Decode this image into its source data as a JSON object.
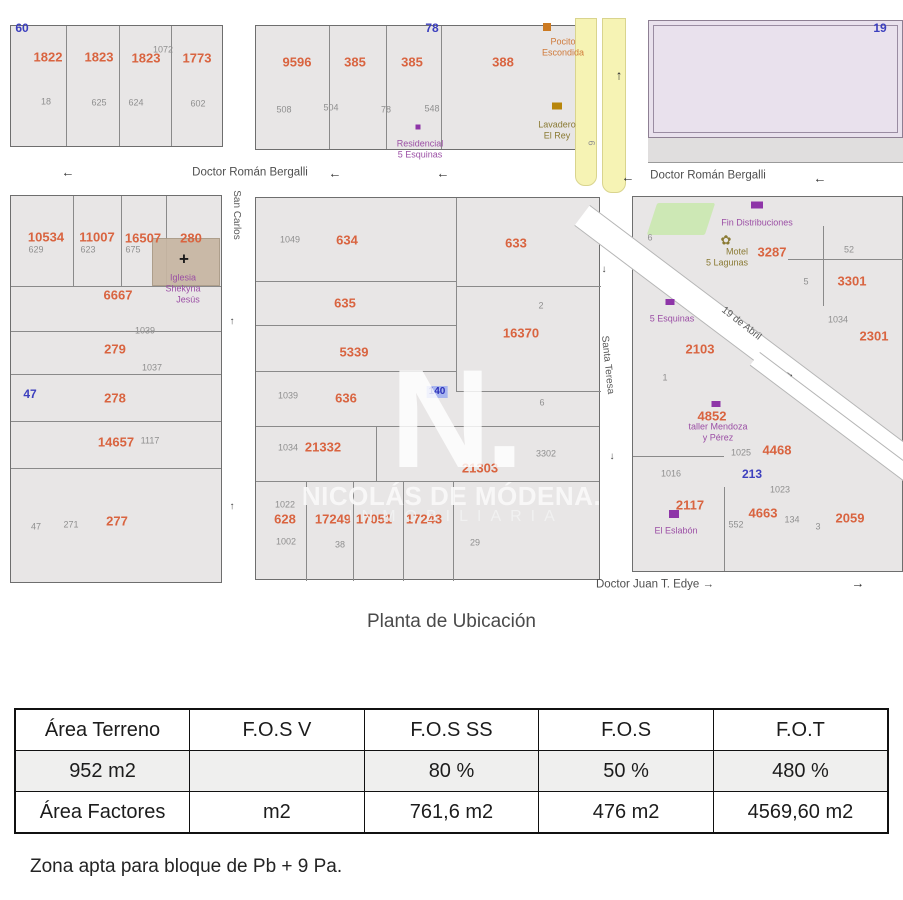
{
  "caption": "Planta de Ubicación",
  "note": "Zona apta para bloque de Pb + 9 Pa.",
  "watermark": {
    "letter": "N.",
    "line1": "NICOLÁS DE MÓDENA.",
    "line2": "INMOBILIARIA"
  },
  "table": {
    "headers": [
      "Área Terreno",
      "F.O.S V",
      "F.O.S SS",
      "F.O.S",
      "F.O.T"
    ],
    "rows": [
      [
        "952 m2",
        "",
        "80 %",
        "50 %",
        "480 %"
      ],
      [
        "Área Factores",
        "m2",
        "761,6 m2",
        "476 m2",
        "4569,60 m2"
      ]
    ]
  },
  "map": {
    "labels": [
      {
        "t": "Doctor Román Bergalli",
        "x": 250,
        "y": 173,
        "cls": "street",
        "name": "street-label-bergalli-west"
      },
      {
        "t": "←",
        "x": 68,
        "y": 172,
        "cls": "arrow",
        "name": "street-direction-arrow"
      },
      {
        "t": "←",
        "x": 335,
        "y": 173,
        "cls": "arrow",
        "name": "street-direction-arrow"
      },
      {
        "t": "←",
        "x": 443,
        "y": 173,
        "cls": "arrow",
        "name": "street-direction-arrow"
      },
      {
        "t": "←",
        "x": 628,
        "y": 177,
        "cls": "arrow",
        "name": "street-direction-arrow"
      },
      {
        "t": "Doctor Román Bergalli",
        "x": 708,
        "y": 176,
        "cls": "street",
        "name": "street-label-bergalli-east"
      },
      {
        "t": "←",
        "x": 820,
        "y": 178,
        "cls": "arrow",
        "name": "street-direction-arrow"
      },
      {
        "t": "San Carlos",
        "x": 236,
        "y": 215,
        "cls": "street-v",
        "rot": 90,
        "name": "street-label-san-carlos"
      },
      {
        "t": "↑",
        "x": 232,
        "y": 322,
        "cls": "arrow-sm",
        "name": "street-direction-arrow"
      },
      {
        "t": "↑",
        "x": 232,
        "y": 507,
        "cls": "arrow-sm",
        "name": "street-direction-arrow"
      },
      {
        "t": "Santa Teresa",
        "x": 607,
        "y": 365,
        "cls": "street-v",
        "rot": 84,
        "name": "street-label-santa-teresa"
      },
      {
        "t": "↓",
        "x": 604,
        "y": 270,
        "cls": "arrow-sm",
        "name": "street-direction-arrow"
      },
      {
        "t": "↓",
        "x": 612,
        "y": 457,
        "cls": "arrow-sm",
        "name": "street-direction-arrow"
      },
      {
        "t": "19 de Abril",
        "x": 741,
        "y": 324,
        "cls": "street-v",
        "rot": 38,
        "name": "street-label-19-de-abril"
      },
      {
        "t": "→",
        "x": 790,
        "y": 374,
        "cls": "arrow-sm",
        "rot": 38,
        "name": "street-direction-arrow"
      },
      {
        "t": "Doctor Juan T. Edye →",
        "x": 655,
        "y": 585,
        "cls": "street",
        "name": "street-label-edye"
      },
      {
        "t": "→",
        "x": 858,
        "y": 583,
        "cls": "arrow",
        "name": "street-direction-arrow"
      },
      {
        "t": "↑",
        "x": 619,
        "y": 75,
        "cls": "arrow",
        "name": "street-direction-arrow"
      },
      {
        "t": "6",
        "x": 591,
        "y": 143,
        "cls": "gray",
        "rot": 90,
        "name": "route-number"
      },
      {
        "t": "6",
        "x": 650,
        "y": 238,
        "cls": "gray",
        "name": "route-number"
      },
      {
        "t": "60",
        "x": 22,
        "y": 28,
        "cls": "blue"
      },
      {
        "t": "78",
        "x": 432,
        "y": 28,
        "cls": "blue"
      },
      {
        "t": "19",
        "x": 880,
        "y": 28,
        "cls": "blue"
      },
      {
        "t": "1822",
        "x": 48,
        "y": 57,
        "cls": "orange"
      },
      {
        "t": "1823",
        "x": 99,
        "y": 57,
        "cls": "orange"
      },
      {
        "t": "1823",
        "x": 146,
        "y": 58,
        "cls": "orange"
      },
      {
        "t": "1072",
        "x": 163,
        "y": 50,
        "cls": "gray"
      },
      {
        "t": "1773",
        "x": 197,
        "y": 58,
        "cls": "orange"
      },
      {
        "t": "18",
        "x": 46,
        "y": 102,
        "cls": "gray"
      },
      {
        "t": "625",
        "x": 99,
        "y": 103,
        "cls": "gray"
      },
      {
        "t": "624",
        "x": 136,
        "y": 103,
        "cls": "gray"
      },
      {
        "t": "602",
        "x": 198,
        "y": 104,
        "cls": "gray"
      },
      {
        "t": "9596",
        "x": 297,
        "y": 62,
        "cls": "orange"
      },
      {
        "t": "385",
        "x": 355,
        "y": 62,
        "cls": "orange"
      },
      {
        "t": "385",
        "x": 412,
        "y": 62,
        "cls": "orange"
      },
      {
        "t": "388",
        "x": 503,
        "y": 62,
        "cls": "orange"
      },
      {
        "t": "508",
        "x": 284,
        "y": 110,
        "cls": "gray"
      },
      {
        "t": "504",
        "x": 331,
        "y": 108,
        "cls": "gray"
      },
      {
        "t": "78",
        "x": 386,
        "y": 110,
        "cls": "gray"
      },
      {
        "t": "548",
        "x": 432,
        "y": 109,
        "cls": "gray"
      },
      {
        "x": 547,
        "y": 27,
        "w": 8,
        "h": 8,
        "cls": "icon icon-orange",
        "name": "poi-marker-icon"
      },
      {
        "t": "Pocito",
        "x": 563,
        "y": 42,
        "cls": "orange-sm",
        "name": "poi-label"
      },
      {
        "t": "Escondida",
        "x": 563,
        "y": 53,
        "cls": "orange-sm",
        "name": "poi-label"
      },
      {
        "x": 418,
        "y": 127,
        "w": 5,
        "h": 5,
        "cls": "icon icon-purple",
        "name": "poi-dot-icon"
      },
      {
        "t": "Residencial",
        "x": 420,
        "y": 144,
        "cls": "purple",
        "name": "poi-label"
      },
      {
        "t": "5 Esquinas",
        "x": 420,
        "y": 155,
        "cls": "purple",
        "name": "poi-label"
      },
      {
        "x": 557,
        "y": 106,
        "w": 10,
        "h": 7,
        "cls": "icon icon-gold",
        "name": "laundry-icon"
      },
      {
        "t": "Lavadero",
        "x": 557,
        "y": 125,
        "cls": "olive",
        "name": "poi-label"
      },
      {
        "t": "El Rey",
        "x": 557,
        "y": 136,
        "cls": "olive",
        "name": "poi-label"
      },
      {
        "t": "10534",
        "x": 46,
        "y": 237,
        "cls": "orange"
      },
      {
        "t": "11007",
        "x": 97,
        "y": 237,
        "cls": "orange"
      },
      {
        "t": "16507",
        "x": 143,
        "y": 238,
        "cls": "orange"
      },
      {
        "t": "280",
        "x": 191,
        "y": 238,
        "cls": "orange"
      },
      {
        "t": "629",
        "x": 36,
        "y": 250,
        "cls": "gray"
      },
      {
        "t": "623",
        "x": 88,
        "y": 250,
        "cls": "gray"
      },
      {
        "t": "675",
        "x": 133,
        "y": 250,
        "cls": "gray"
      },
      {
        "t": "+",
        "x": 184,
        "y": 259,
        "cls": "cross",
        "name": "church-cross-icon"
      },
      {
        "t": "Iglesia",
        "x": 183,
        "y": 278,
        "cls": "purple",
        "name": "poi-label"
      },
      {
        "t": "Shekyna",
        "x": 183,
        "y": 289,
        "cls": "purple",
        "name": "poi-label"
      },
      {
        "t": "Jesús",
        "x": 188,
        "y": 300,
        "cls": "purple",
        "name": "poi-label"
      },
      {
        "t": "6667",
        "x": 118,
        "y": 295,
        "cls": "orange"
      },
      {
        "t": "1039",
        "x": 145,
        "y": 331,
        "cls": "gray"
      },
      {
        "t": "279",
        "x": 115,
        "y": 349,
        "cls": "orange"
      },
      {
        "t": "1037",
        "x": 152,
        "y": 368,
        "cls": "gray"
      },
      {
        "t": "47",
        "x": 30,
        "y": 394,
        "cls": "blue"
      },
      {
        "t": "278",
        "x": 115,
        "y": 398,
        "cls": "orange"
      },
      {
        "t": "14657",
        "x": 116,
        "y": 442,
        "cls": "orange"
      },
      {
        "t": "1117",
        "x": 150,
        "y": 441,
        "cls": "gray"
      },
      {
        "t": "277",
        "x": 117,
        "y": 521,
        "cls": "orange"
      },
      {
        "t": "47",
        "x": 36,
        "y": 527,
        "cls": "gray"
      },
      {
        "t": "271",
        "x": 71,
        "y": 525,
        "cls": "gray"
      },
      {
        "t": "1049",
        "x": 290,
        "y": 240,
        "cls": "gray"
      },
      {
        "t": "634",
        "x": 347,
        "y": 240,
        "cls": "orange"
      },
      {
        "t": "633",
        "x": 516,
        "y": 243,
        "cls": "orange"
      },
      {
        "t": "635",
        "x": 345,
        "y": 303,
        "cls": "orange"
      },
      {
        "t": "2",
        "x": 541,
        "y": 306,
        "cls": "gray"
      },
      {
        "t": "16370",
        "x": 521,
        "y": 333,
        "cls": "orange"
      },
      {
        "t": "5339",
        "x": 354,
        "y": 352,
        "cls": "orange"
      },
      {
        "t": "1039",
        "x": 288,
        "y": 396,
        "cls": "gray"
      },
      {
        "t": "636",
        "x": 346,
        "y": 398,
        "cls": "orange"
      },
      {
        "t": "140",
        "x": 437,
        "y": 392,
        "cls": "blue-hl",
        "name": "highlighted-parcel"
      },
      {
        "t": "6",
        "x": 542,
        "y": 403,
        "cls": "gray"
      },
      {
        "t": "1034",
        "x": 288,
        "y": 448,
        "cls": "gray"
      },
      {
        "t": "21332",
        "x": 323,
        "y": 447,
        "cls": "orange"
      },
      {
        "t": "3302",
        "x": 546,
        "y": 454,
        "cls": "gray"
      },
      {
        "t": "21303",
        "x": 480,
        "y": 468,
        "cls": "orange"
      },
      {
        "t": "1022",
        "x": 285,
        "y": 505,
        "cls": "gray"
      },
      {
        "t": "628",
        "x": 285,
        "y": 519,
        "cls": "orange"
      },
      {
        "t": "17249",
        "x": 333,
        "y": 519,
        "cls": "orange"
      },
      {
        "t": "17051",
        "x": 374,
        "y": 519,
        "cls": "orange"
      },
      {
        "t": "17243",
        "x": 424,
        "y": 519,
        "cls": "orange"
      },
      {
        "t": "1002",
        "x": 286,
        "y": 542,
        "cls": "gray"
      },
      {
        "t": "38",
        "x": 340,
        "y": 545,
        "cls": "gray"
      },
      {
        "t": "29",
        "x": 475,
        "y": 543,
        "cls": "gray"
      },
      {
        "x": 757,
        "y": 205,
        "w": 12,
        "h": 7,
        "cls": "icon icon-purple",
        "name": "store-icon"
      },
      {
        "t": "Fin Distribuciones",
        "x": 757,
        "y": 223,
        "cls": "purple",
        "name": "poi-label"
      },
      {
        "t": "✿",
        "x": 726,
        "y": 240,
        "cls": "olive-icon",
        "name": "flower-icon"
      },
      {
        "t": "Motel",
        "x": 737,
        "y": 252,
        "cls": "olive",
        "name": "poi-label"
      },
      {
        "t": "5 Lagunas",
        "x": 727,
        "y": 263,
        "cls": "olive",
        "name": "poi-label"
      },
      {
        "t": "3287",
        "x": 772,
        "y": 252,
        "cls": "orange"
      },
      {
        "t": "52",
        "x": 849,
        "y": 250,
        "cls": "gray"
      },
      {
        "t": "5",
        "x": 806,
        "y": 282,
        "cls": "gray"
      },
      {
        "t": "3301",
        "x": 852,
        "y": 281,
        "cls": "orange"
      },
      {
        "t": "1034",
        "x": 838,
        "y": 320,
        "cls": "gray"
      },
      {
        "t": "2301",
        "x": 874,
        "y": 336,
        "cls": "orange"
      },
      {
        "x": 670,
        "y": 302,
        "w": 9,
        "h": 6,
        "cls": "icon icon-purple",
        "name": "poi-marker-icon"
      },
      {
        "t": "5 Esquinas",
        "x": 672,
        "y": 319,
        "cls": "purple",
        "name": "poi-label"
      },
      {
        "t": "2103",
        "x": 700,
        "y": 349,
        "cls": "orange"
      },
      {
        "t": "1",
        "x": 665,
        "y": 378,
        "cls": "gray"
      },
      {
        "x": 716,
        "y": 404,
        "w": 9,
        "h": 6,
        "cls": "icon icon-purple",
        "name": "poi-marker-icon"
      },
      {
        "t": "4852",
        "x": 712,
        "y": 416,
        "cls": "orange"
      },
      {
        "t": "taller Mendoza",
        "x": 718,
        "y": 427,
        "cls": "purple",
        "name": "poi-label"
      },
      {
        "t": "y Pérez",
        "x": 718,
        "y": 438,
        "cls": "purple",
        "name": "poi-label"
      },
      {
        "t": "1025",
        "x": 741,
        "y": 453,
        "cls": "gray"
      },
      {
        "t": "4468",
        "x": 777,
        "y": 450,
        "cls": "orange"
      },
      {
        "t": "213",
        "x": 752,
        "y": 474,
        "cls": "blue"
      },
      {
        "t": "1023",
        "x": 780,
        "y": 490,
        "cls": "gray"
      },
      {
        "t": "1016",
        "x": 671,
        "y": 474,
        "cls": "gray"
      },
      {
        "t": "2117",
        "x": 690,
        "y": 505,
        "cls": "orange"
      },
      {
        "x": 674,
        "y": 514,
        "w": 10,
        "h": 8,
        "cls": "icon icon-purple",
        "name": "cart-icon"
      },
      {
        "t": "El Eslabón",
        "x": 676,
        "y": 531,
        "cls": "purple",
        "name": "poi-label"
      },
      {
        "t": "552",
        "x": 736,
        "y": 525,
        "cls": "gray"
      },
      {
        "t": "4663",
        "x": 763,
        "y": 513,
        "cls": "orange"
      },
      {
        "t": "134",
        "x": 792,
        "y": 520,
        "cls": "gray"
      },
      {
        "t": "3",
        "x": 818,
        "y": 527,
        "cls": "gray"
      },
      {
        "t": "2059",
        "x": 850,
        "y": 518,
        "cls": "orange"
      }
    ]
  }
}
